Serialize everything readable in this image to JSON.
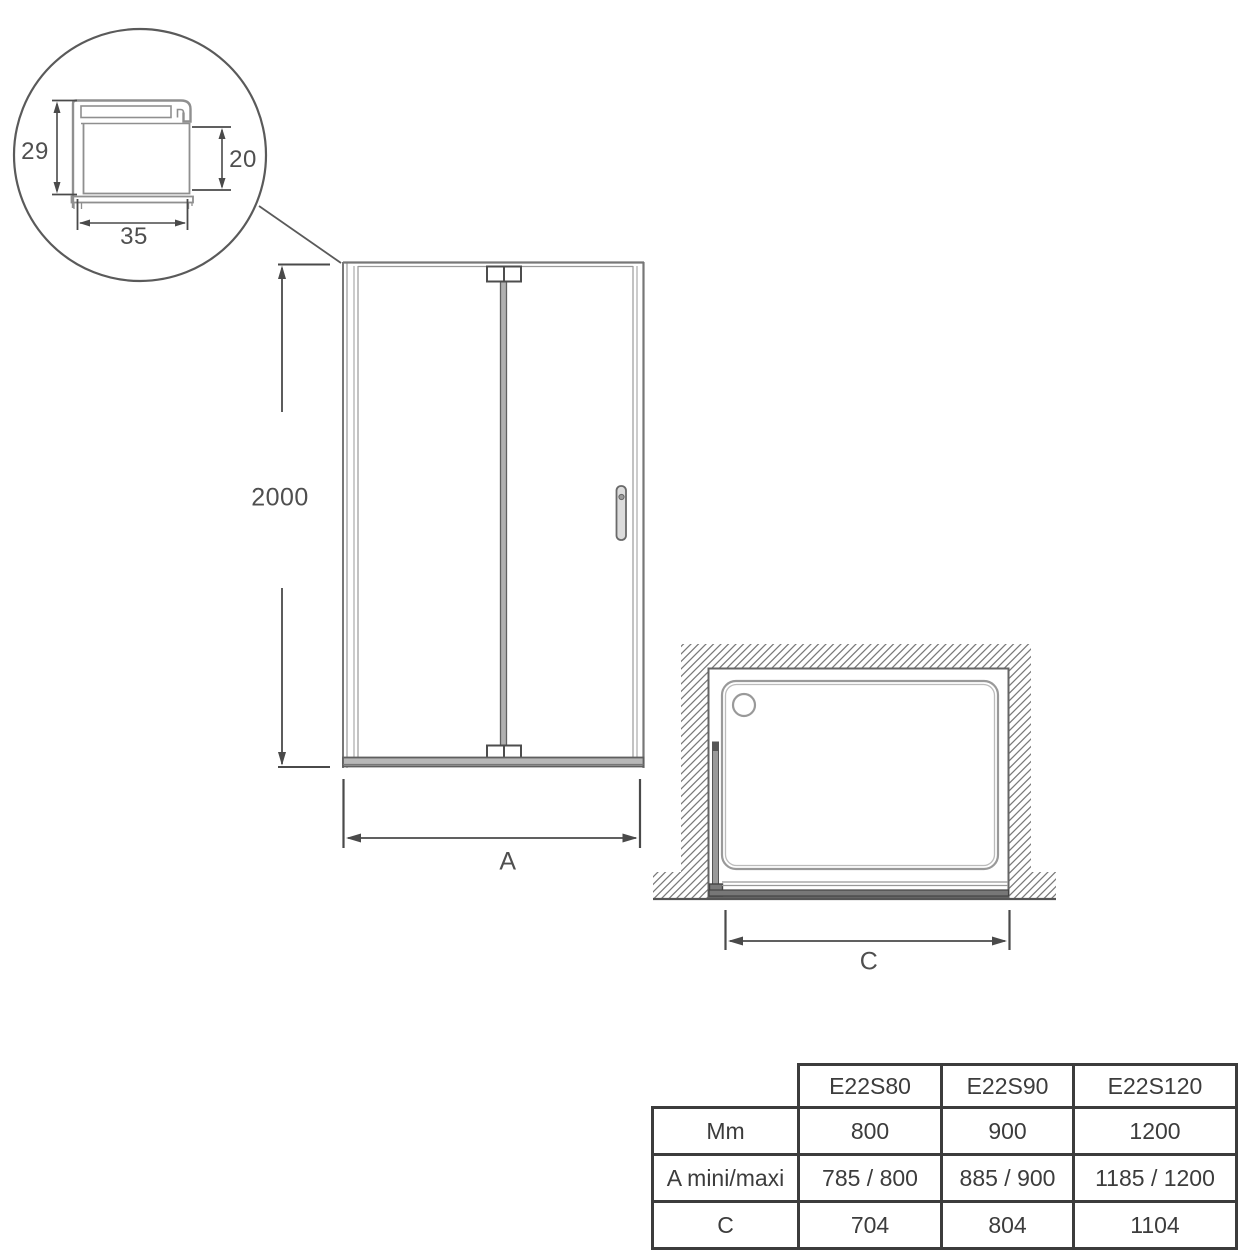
{
  "drawing": {
    "detail_view": {
      "description": "profile cross-section detail in magnifier circle",
      "dim_total_height_mm": "29",
      "dim_glass_height_mm": "20",
      "dim_width_mm": "35"
    },
    "front_view": {
      "description": "front elevation of folding shower door",
      "dim_height_mm": "2000",
      "dim_width_label": "A"
    },
    "plan_view": {
      "description": "top view of shower tray in alcove with hatched walls",
      "dim_width_label": "C"
    }
  },
  "table": {
    "columns": [
      "E22S80",
      "E22S90",
      "E22S120"
    ],
    "rows": [
      {
        "label": "Mm",
        "values": [
          "800",
          "900",
          "1200"
        ]
      },
      {
        "label": "A mini/maxi",
        "values": [
          "785 / 800",
          "885 / 900",
          "1185 / 1200"
        ]
      },
      {
        "label": "C",
        "values": [
          "704",
          "804",
          "1104"
        ]
      }
    ]
  },
  "colors": {
    "dimension_line": "#4a4a4a",
    "profile_line": "#8f8f8f",
    "frame_line": "#777777",
    "hatch_line": "#7a7a7a",
    "table_border": "#3c3c3c",
    "text": "#4f4f4f",
    "background": "#ffffff"
  }
}
